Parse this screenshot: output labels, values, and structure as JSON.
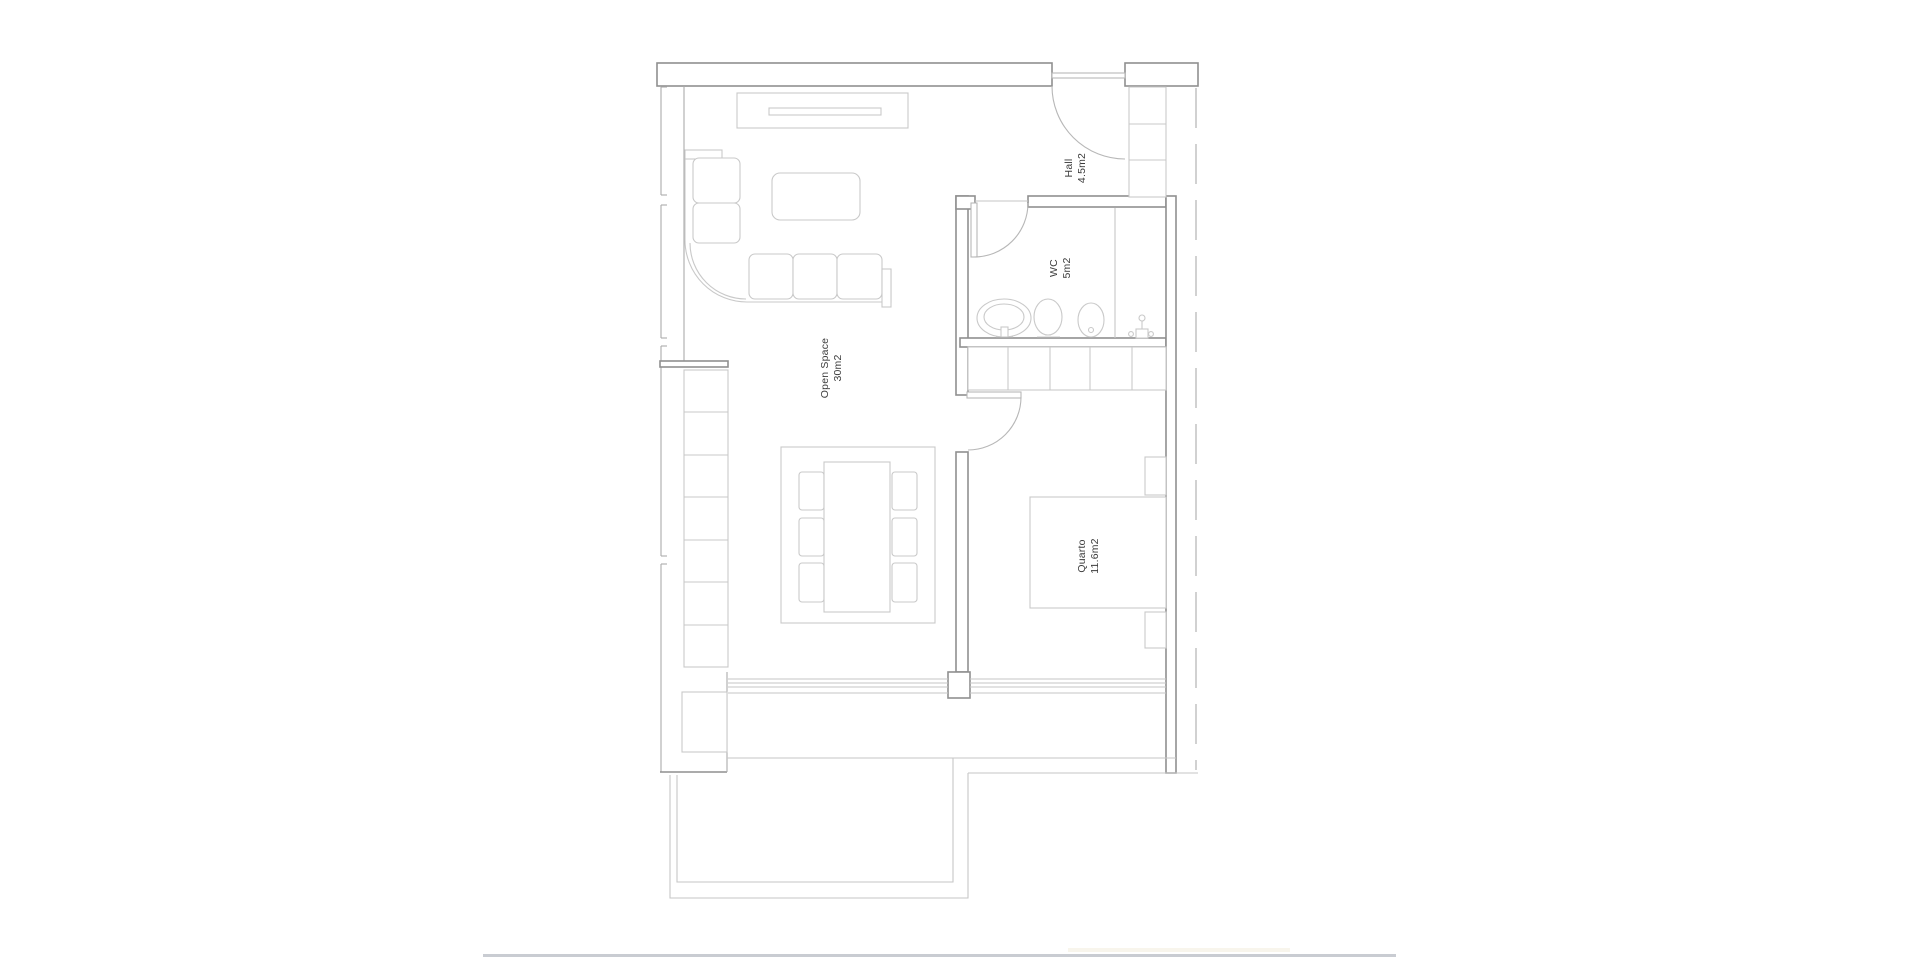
{
  "rooms": [
    {
      "name": "Open Space",
      "area": "30m2"
    },
    {
      "name": "Hall",
      "area": "4.5m2"
    },
    {
      "name": "WC",
      "area": "5m2"
    },
    {
      "name": "Quarto",
      "area": "11.6m2"
    }
  ],
  "colors": {
    "wall": "#8f8f8f",
    "wall_light": "#ababab",
    "furniture": "#c9c9c9",
    "door": "#b7b7b7",
    "glass": "#c6c6c6",
    "label": "#3c3c3c",
    "page_line": "#c9ccd2",
    "page_faint": "#f8f5ec"
  }
}
